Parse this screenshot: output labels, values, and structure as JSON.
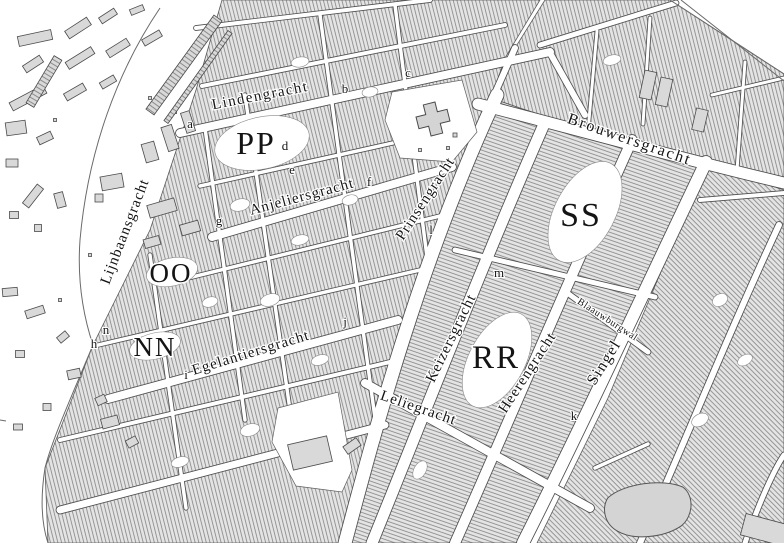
{
  "map": {
    "width": 784,
    "height": 543,
    "colors": {
      "background": "#ffffff",
      "block_fill": "#e4e4e4",
      "hatch_line": "#8e8e8e",
      "district_stroke": "#5a5a5a",
      "street_casing": "#4d4d4d",
      "street_fill": "#ffffff",
      "building_fill": "#d9d9d9",
      "building_stroke": "#4a4a4a",
      "landmark_fill": "#d4d4d4",
      "label_color": "#141414",
      "boundary_line": "#6a6a6a"
    },
    "districts": [
      {
        "id": "jordaan",
        "angle": -14,
        "pts": [
          [
            222,
            0
          ],
          [
            540,
            0
          ],
          [
            505,
            58
          ],
          [
            470,
            160
          ],
          [
            420,
            300
          ],
          [
            345,
            543
          ],
          [
            48,
            543
          ],
          [
            45,
            468
          ],
          [
            93,
            345
          ],
          [
            150,
            230
          ],
          [
            196,
            90
          ]
        ]
      },
      {
        "id": "canal-belt",
        "angle": -71,
        "pts": [
          [
            345,
            543
          ],
          [
            420,
            300
          ],
          [
            470,
            160
          ],
          [
            497,
            100
          ],
          [
            520,
            108
          ],
          [
            600,
            134
          ],
          [
            700,
            162
          ],
          [
            706,
            164
          ],
          [
            655,
            265
          ],
          [
            600,
            400
          ],
          [
            530,
            543
          ]
        ]
      },
      {
        "id": "east-of-singel",
        "angle": 135,
        "pts": [
          [
            537,
            543
          ],
          [
            608,
            398
          ],
          [
            668,
            255
          ],
          [
            710,
            166
          ],
          [
            784,
            190
          ],
          [
            784,
            543
          ]
        ]
      },
      {
        "id": "haarlemmer-strip",
        "angle": -14,
        "pts": [
          [
            497,
            100
          ],
          [
            515,
            48
          ],
          [
            545,
            0
          ],
          [
            670,
            0
          ],
          [
            784,
            74
          ],
          [
            784,
            188
          ],
          [
            700,
            162
          ],
          [
            600,
            134
          ],
          [
            520,
            108
          ]
        ]
      }
    ],
    "streets": [
      {
        "id": "palmstraat",
        "line": [
          196,
          28,
          430,
          0
        ],
        "w": 4
      },
      {
        "id": "goudsbloemstraat",
        "line": [
          202,
          86,
          505,
          25
        ],
        "w": 4
      },
      {
        "id": "lindengracht",
        "line": [
          180,
          133,
          550,
          52
        ],
        "w": 8
      },
      {
        "id": "lindengracht-link",
        "line": [
          550,
          53,
          585,
          115
        ],
        "w": 6
      },
      {
        "id": "boomstraat",
        "line": [
          200,
          186,
          460,
          128
        ],
        "w": 3.5
      },
      {
        "id": "anjeliersgracht",
        "line": [
          212,
          237,
          452,
          167
        ],
        "w": 8
      },
      {
        "id": "tuinstraat",
        "line": [
          172,
          282,
          440,
          216
        ],
        "w": 3.5
      },
      {
        "id": "egelantiersstraat",
        "line": [
          94,
          346,
          420,
          270
        ],
        "w": 3.5
      },
      {
        "id": "egelantiersgracht",
        "line": [
          108,
          399,
          398,
          320
        ],
        "w": 8
      },
      {
        "id": "nieuwe-leliestraat",
        "line": [
          60,
          440,
          390,
          362
        ],
        "w": 4
      },
      {
        "id": "bloemgracht",
        "line": [
          60,
          510,
          385,
          425
        ],
        "w": 7
      },
      {
        "id": "cross-1",
        "line": [
          205,
          128,
          245,
          420
        ],
        "w": 3.5
      },
      {
        "id": "cross-2",
        "line": [
          150,
          255,
          186,
          508
        ],
        "w": 3.5
      },
      {
        "id": "cross-3",
        "line": [
          245,
          95,
          300,
          480
        ],
        "w": 3.5
      },
      {
        "id": "cross-4",
        "line": [
          320,
          15,
          378,
          440
        ],
        "w": 3.5
      },
      {
        "id": "cross-5",
        "line": [
          395,
          5,
          428,
          265
        ],
        "w": 3.5
      },
      {
        "id": "prinsengracht",
        "path": "M345,543 C375,430 420,260 497,95",
        "w": 13
      },
      {
        "id": "korte-prinsengracht",
        "line": [
          492,
          100,
          515,
          48
        ],
        "w": 6
      },
      {
        "id": "keizersgracht",
        "path": "M372,543 C430,400 480,270 545,122",
        "w": 11
      },
      {
        "id": "heerengracht",
        "path": "M455,543 C505,430 560,300 632,140",
        "w": 10
      },
      {
        "id": "singel",
        "path": "M523,543 C580,430 645,290 706,162",
        "w": 12
      },
      {
        "id": "brouwersgracht",
        "path": "M478,104 C560,125 670,156 784,183",
        "w": 11
      },
      {
        "id": "leliegracht",
        "line": [
          365,
          383,
          590,
          508
        ],
        "w": 8
      },
      {
        "id": "herenstraat",
        "line": [
          455,
          250,
          655,
          297
        ],
        "w": 5
      },
      {
        "id": "blaauwburgwal",
        "line": [
          566,
          292,
          648,
          352
        ],
        "w": 5
      },
      {
        "id": "haarlemmerdijk",
        "line": [
          540,
          45,
          676,
          3
        ],
        "w": 5
      },
      {
        "id": "alley-n1",
        "line": [
          597,
          31,
          588,
          131
        ],
        "w": 3
      },
      {
        "id": "alley-n2",
        "line": [
          650,
          18,
          643,
          124
        ],
        "w": 3
      },
      {
        "id": "alley-n3",
        "line": [
          745,
          62,
          737,
          170
        ],
        "w": 3
      },
      {
        "id": "east-curve-1",
        "path": "M640,543 C690,430 730,330 779,225",
        "w": 6
      },
      {
        "id": "east-curve-2",
        "path": "M745,543 C760,500 775,468 784,455",
        "w": 5
      },
      {
        "id": "east-link-1",
        "line": [
          700,
          200,
          784,
          193
        ],
        "w": 4
      },
      {
        "id": "east-link-2",
        "line": [
          712,
          95,
          784,
          78
        ],
        "w": 3
      },
      {
        "id": "east-link-3",
        "line": [
          595,
          468,
          648,
          444
        ],
        "w": 3.5
      }
    ],
    "boundaries": [
      {
        "id": "harbour-edge-outer",
        "path": "M670,0 L784,74"
      },
      {
        "id": "harbour-edge-inner",
        "path": "M681,0 L784,81"
      },
      {
        "id": "field-edge-north",
        "path": "M160,8 C118,70 88,150 80,240 C77,282 84,318 93,345"
      },
      {
        "id": "field-edge-south",
        "path": "M93,345 C70,400 52,440 45,468 C40,500 42,525 48,543"
      },
      {
        "id": "edge-tick",
        "path": "M0,420 L6,421"
      }
    ],
    "plazas": [
      {
        "id": "noordermarkt",
        "pts": [
          [
            392,
            92
          ],
          [
            462,
            80
          ],
          [
            477,
            132
          ],
          [
            452,
            162
          ],
          [
            400,
            158
          ],
          [
            385,
            120
          ]
        ]
      },
      {
        "id": "westermarkt",
        "pts": [
          [
            278,
            408
          ],
          [
            338,
            392
          ],
          [
            352,
            470
          ],
          [
            342,
            492
          ],
          [
            296,
            486
          ],
          [
            272,
            442
          ]
        ]
      }
    ],
    "courtyards": [
      {
        "id": "pp-court",
        "cx": 262,
        "cy": 143,
        "rx": 48,
        "ry": 26,
        "rot": -12
      },
      {
        "id": "oo-court",
        "cx": 172,
        "cy": 272,
        "rx": 26,
        "ry": 14,
        "rot": -12
      },
      {
        "id": "nn-court",
        "cx": 155,
        "cy": 346,
        "rx": 26,
        "ry": 13,
        "rot": -14
      },
      {
        "id": "rr-court",
        "cx": 497,
        "cy": 360,
        "rx": 52,
        "ry": 28,
        "rot": -62
      },
      {
        "id": "ss-court",
        "cx": 585,
        "cy": 212,
        "rx": 55,
        "ry": 30,
        "rot": -62
      },
      {
        "id": "c1",
        "cx": 240,
        "cy": 205,
        "rx": 10,
        "ry": 6,
        "rot": -14
      },
      {
        "id": "c2",
        "cx": 300,
        "cy": 240,
        "rx": 9,
        "ry": 5,
        "rot": -14
      },
      {
        "id": "c3",
        "cx": 350,
        "cy": 200,
        "rx": 8,
        "ry": 5,
        "rot": -14
      },
      {
        "id": "c4",
        "cx": 270,
        "cy": 300,
        "rx": 10,
        "ry": 6,
        "rot": -16
      },
      {
        "id": "c5",
        "cx": 210,
        "cy": 302,
        "rx": 8,
        "ry": 5,
        "rot": -16
      },
      {
        "id": "c6",
        "cx": 320,
        "cy": 360,
        "rx": 9,
        "ry": 5,
        "rot": -16
      },
      {
        "id": "c7",
        "cx": 250,
        "cy": 430,
        "rx": 10,
        "ry": 6,
        "rot": -16
      },
      {
        "id": "c8",
        "cx": 180,
        "cy": 462,
        "rx": 9,
        "ry": 5,
        "rot": -16
      },
      {
        "id": "c9",
        "cx": 300,
        "cy": 62,
        "rx": 9,
        "ry": 5,
        "rot": -10
      },
      {
        "id": "c10",
        "cx": 370,
        "cy": 92,
        "rx": 8,
        "ry": 5,
        "rot": -10
      },
      {
        "id": "c11",
        "cx": 420,
        "cy": 470,
        "rx": 10,
        "ry": 6,
        "rot": -60
      },
      {
        "id": "c12",
        "cx": 720,
        "cy": 300,
        "rx": 8,
        "ry": 6,
        "rot": -30
      },
      {
        "id": "c13",
        "cx": 700,
        "cy": 420,
        "rx": 9,
        "ry": 6,
        "rot": -30
      },
      {
        "id": "c14",
        "cx": 745,
        "cy": 360,
        "rx": 8,
        "ry": 5,
        "rot": -30
      },
      {
        "id": "c15",
        "cx": 612,
        "cy": 60,
        "rx": 9,
        "ry": 5,
        "rot": -14
      }
    ],
    "buildings": [
      [
        35,
        38,
        34,
        10,
        -12
      ],
      [
        78,
        28,
        26,
        9,
        -33
      ],
      [
        108,
        16,
        18,
        7,
        -33
      ],
      [
        137,
        10,
        14,
        6,
        -22
      ],
      [
        33,
        64,
        20,
        8,
        -33
      ],
      [
        80,
        58,
        30,
        8,
        -32
      ],
      [
        118,
        48,
        24,
        8,
        -32
      ],
      [
        152,
        38,
        20,
        7,
        -30
      ],
      [
        28,
        98,
        38,
        9,
        -28
      ],
      [
        75,
        92,
        22,
        8,
        -30
      ],
      [
        108,
        82,
        16,
        7,
        -30
      ],
      [
        16,
        128,
        20,
        13,
        -8
      ],
      [
        45,
        138,
        15,
        8,
        -25
      ],
      [
        12,
        163,
        12,
        8,
        0
      ],
      [
        33,
        196,
        24,
        8,
        -52
      ],
      [
        60,
        200,
        9,
        15,
        -15
      ],
      [
        14,
        215,
        9,
        7,
        0
      ],
      [
        38,
        228,
        7,
        7,
        0
      ],
      [
        112,
        182,
        22,
        14,
        -10
      ],
      [
        99,
        198,
        8,
        8,
        0
      ],
      [
        150,
        152,
        13,
        19,
        -16
      ],
      [
        170,
        138,
        11,
        25,
        -18
      ],
      [
        188,
        122,
        9,
        21,
        -18
      ],
      [
        162,
        208,
        28,
        13,
        -16
      ],
      [
        190,
        228,
        19,
        11,
        -16
      ],
      [
        152,
        242,
        16,
        9,
        -16
      ],
      [
        10,
        292,
        15,
        8,
        -5
      ],
      [
        35,
        312,
        19,
        8,
        -18
      ],
      [
        63,
        337,
        11,
        7,
        -40
      ],
      [
        20,
        354,
        9,
        7,
        0
      ],
      [
        74,
        374,
        13,
        9,
        -12
      ],
      [
        101,
        400,
        10,
        8,
        -25
      ],
      [
        47,
        407,
        8,
        7,
        0
      ],
      [
        18,
        427,
        9,
        6,
        0
      ],
      [
        110,
        422,
        17,
        10,
        -15
      ],
      [
        132,
        442,
        11,
        8,
        -28
      ],
      [
        55,
        120,
        3,
        3,
        0
      ],
      [
        150,
        98,
        3,
        3,
        0
      ],
      [
        175,
        112,
        3,
        3,
        0
      ],
      [
        90,
        255,
        3,
        3,
        0
      ],
      [
        60,
        300,
        3,
        3,
        0
      ],
      [
        455,
        135,
        4,
        4,
        0
      ],
      [
        448,
        148,
        3,
        3,
        0
      ],
      [
        420,
        150,
        3,
        3,
        0
      ],
      [
        310,
        453,
        40,
        26,
        -13
      ],
      [
        352,
        446,
        16,
        9,
        -35
      ],
      [
        648,
        85,
        12,
        28,
        12
      ],
      [
        664,
        92,
        12,
        28,
        12
      ],
      [
        700,
        120,
        12,
        22,
        13
      ],
      [
        765,
        530,
        45,
        22,
        15
      ]
    ],
    "ladders": [
      {
        "x1": 150,
        "y1": 112,
        "x2": 218,
        "y2": 18,
        "w": 10
      },
      {
        "x1": 166,
        "y1": 122,
        "x2": 230,
        "y2": 32,
        "w": 5
      },
      {
        "x1": 30,
        "y1": 105,
        "x2": 58,
        "y2": 58,
        "w": 9
      }
    ],
    "landmarks": {
      "noorderkerk": {
        "x": 433,
        "y": 119,
        "rot": -14
      },
      "round_building": {
        "x": 650,
        "y": 509,
        "rot": -10
      }
    },
    "street_labels": [
      {
        "text": "Lijnbaansgracht",
        "x": 129,
        "y": 233,
        "rot": -69,
        "size": 15,
        "ls": 1
      },
      {
        "text": "Lindengracht",
        "x": 261,
        "y": 100,
        "rot": -11,
        "size": 15,
        "ls": 1.5
      },
      {
        "text": "Anjeliersgracht",
        "x": 303,
        "y": 201,
        "rot": -15,
        "size": 15,
        "ls": 1
      },
      {
        "text": "Egelantiersgracht",
        "x": 252,
        "y": 357,
        "rot": -17,
        "size": 15,
        "ls": 1
      },
      {
        "text": "Prinsengracht",
        "x": 429,
        "y": 201,
        "rot": -57,
        "size": 15,
        "ls": 1
      },
      {
        "text": "Keizersgracht",
        "x": 455,
        "y": 340,
        "rot": -64,
        "size": 15,
        "ls": 1
      },
      {
        "text": "Heerengracht",
        "x": 531,
        "y": 375,
        "rot": -57,
        "size": 15,
        "ls": 1
      },
      {
        "text": "Singel",
        "x": 608,
        "y": 365,
        "rot": -58,
        "size": 16,
        "ls": 1.5
      },
      {
        "text": "Brouwersgracht",
        "x": 628,
        "y": 144,
        "rot": 19,
        "size": 16,
        "ls": 2
      },
      {
        "text": "Leliegracht",
        "x": 417,
        "y": 412,
        "rot": 19,
        "size": 15,
        "ls": 1
      },
      {
        "text": "Blaauwburgwal",
        "x": 606,
        "y": 322,
        "rot": 33,
        "size": 10,
        "ls": 0.5
      }
    ],
    "block_letters": [
      {
        "t": "PP",
        "x": 256,
        "y": 154,
        "size": 32
      },
      {
        "t": "OO",
        "x": 171,
        "y": 282,
        "size": 27
      },
      {
        "t": "NN",
        "x": 155,
        "y": 356,
        "size": 27
      },
      {
        "t": "RR",
        "x": 496,
        "y": 368,
        "size": 33
      },
      {
        "t": "SS",
        "x": 581,
        "y": 226,
        "size": 34
      }
    ],
    "index_letters": [
      {
        "t": "a",
        "x": 190,
        "y": 128
      },
      {
        "t": "b",
        "x": 345,
        "y": 93
      },
      {
        "t": "c",
        "x": 408,
        "y": 77
      },
      {
        "t": "d",
        "x": 285,
        "y": 150
      },
      {
        "t": "e",
        "x": 292,
        "y": 174
      },
      {
        "t": "f",
        "x": 369,
        "y": 186
      },
      {
        "t": "g",
        "x": 219,
        "y": 225
      },
      {
        "t": "h",
        "x": 94,
        "y": 348
      },
      {
        "t": "i",
        "x": 186,
        "y": 379
      },
      {
        "t": "j",
        "x": 345,
        "y": 326
      },
      {
        "t": "k",
        "x": 574,
        "y": 420
      },
      {
        "t": "l",
        "x": 431,
        "y": 234
      },
      {
        "t": "m",
        "x": 499,
        "y": 277
      },
      {
        "t": "n",
        "x": 106,
        "y": 334
      }
    ]
  }
}
